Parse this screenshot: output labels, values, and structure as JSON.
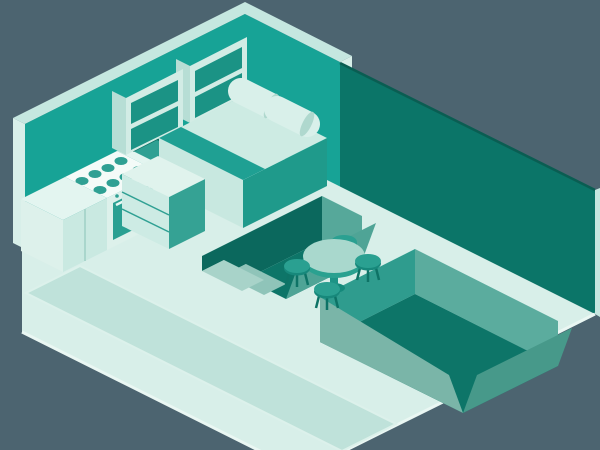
{
  "scene": {
    "type": "isometric-room-illustration",
    "subject": "studio apartment cutaway",
    "projection": "isometric 2:1",
    "canvas": {
      "width": 600,
      "height": 450
    }
  },
  "palette": {
    "bg": "#4C6470",
    "wallTeal": "#17A396",
    "wallEdge": "#C5E7E0",
    "wallCap": "#D8EFE9",
    "wallDark": "#0B7568",
    "wallDarkLine": "#0A5D52",
    "floor": "#D8EFE9",
    "floorEdge": "#EAF7F3",
    "rug": "#BFE2DA",
    "rugEdge": "#DCF1EB",
    "recessFloor": "#0D7568",
    "recessShadow": "#0B685D",
    "recessEnd": "#56A89A",
    "recessRamp": "#4FA496",
    "stepUpper": "#A8D3C9",
    "stepLower": "#8FC4B9",
    "pitBack": "#5BAC9E",
    "pitWest": "#2F9C8E",
    "pitRampFront": "#7AB5A8",
    "pitRampEast": "#47998A",
    "counterTop": "#E3F5F0",
    "counterFront": "#C9E9E1",
    "counterLight": "#DDF1EB",
    "cooktop": "#F4FBF8",
    "burner": "#2FA093",
    "oven": "#2AA092",
    "ovenHandle": "#E9F8F3",
    "basin": "#2FA093",
    "basinEdge": "#0C6F63",
    "cabinetLine": "#A9D6CC",
    "shelfFrame": "#D2ECE5",
    "shelfSide": "#B7DED5",
    "shelfOpening": "#1B9385",
    "bedTop": "#CDEBE3",
    "bedStripe": "#1FA093",
    "bedSideLight": "#C8E8E0",
    "bedSideTeal": "#1F9A8B",
    "pillow": "#D9F0EA",
    "pillowEnd": "#AFD8CE",
    "dresserFront": "#CDEBE4",
    "dresserSide": "#35A294",
    "dresserTop": "#E0F3ED",
    "drawerLine": "#2FA093",
    "tableTop": "#A9D8CD",
    "tableSide": "#2AA190",
    "pedestal": "#1E9486",
    "tableBase": "#15897B",
    "stoolSeat": "#2AA091",
    "stoolSeatDark": "#17887B",
    "stoolLeg": "#0E7366"
  },
  "objects": [
    {
      "name": "left-wall",
      "label": "back-left wall"
    },
    {
      "name": "right-wall",
      "label": "back-right wall (dark)"
    },
    {
      "name": "floor",
      "label": "main floor slab"
    },
    {
      "name": "rug",
      "label": "area rug"
    },
    {
      "name": "sunken-channel",
      "label": "sunken channel with steps"
    },
    {
      "name": "sunken-pit",
      "label": "sunken lounge pit"
    },
    {
      "name": "kitchen-counter",
      "label": "kitchen counter run"
    },
    {
      "name": "sink",
      "label": "kitchen sink"
    },
    {
      "name": "stove",
      "label": "stove with 8 burners and oven"
    },
    {
      "name": "wall-shelves",
      "label": "two wall shelf units"
    },
    {
      "name": "bed",
      "label": "double bed with 2 pillows"
    },
    {
      "name": "dresser",
      "label": "3-drawer dresser"
    },
    {
      "name": "dining-table",
      "label": "round pedestal dining table"
    },
    {
      "name": "stools",
      "label": "4 three-legged stools"
    }
  ]
}
